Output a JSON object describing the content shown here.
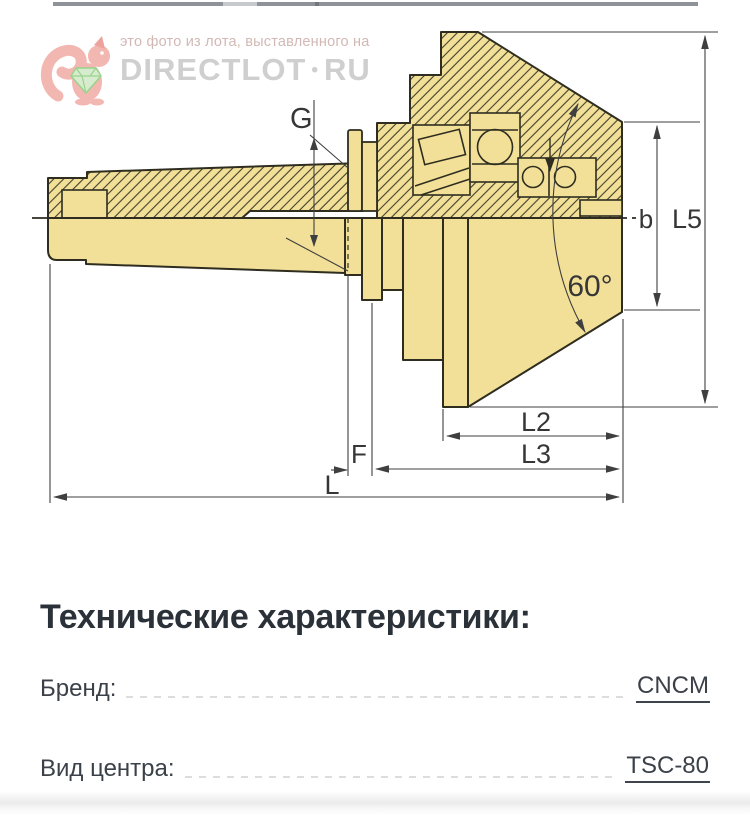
{
  "watermark": {
    "line1": "это фото из лота, выставленного на",
    "brand": "DIRECTLOT",
    "separator": "•",
    "brand_suffix": "RU"
  },
  "drawing": {
    "type": "technical-drawing-live-center-cross-section",
    "labels": {
      "g": "G",
      "b": "b",
      "l5": "L5",
      "angle": "60°",
      "l2": "L2",
      "l3": "L3",
      "f": "F",
      "l": "L"
    },
    "colors": {
      "fill": "#f3e098",
      "outline": "#2e2d20",
      "dimension": "#3f3f3f"
    }
  },
  "specs": {
    "heading": "Технические характеристики:",
    "rows": [
      {
        "label": "Бренд:",
        "value": "CNCM"
      },
      {
        "label": "Вид центра:",
        "value": "TSC-80"
      }
    ]
  }
}
